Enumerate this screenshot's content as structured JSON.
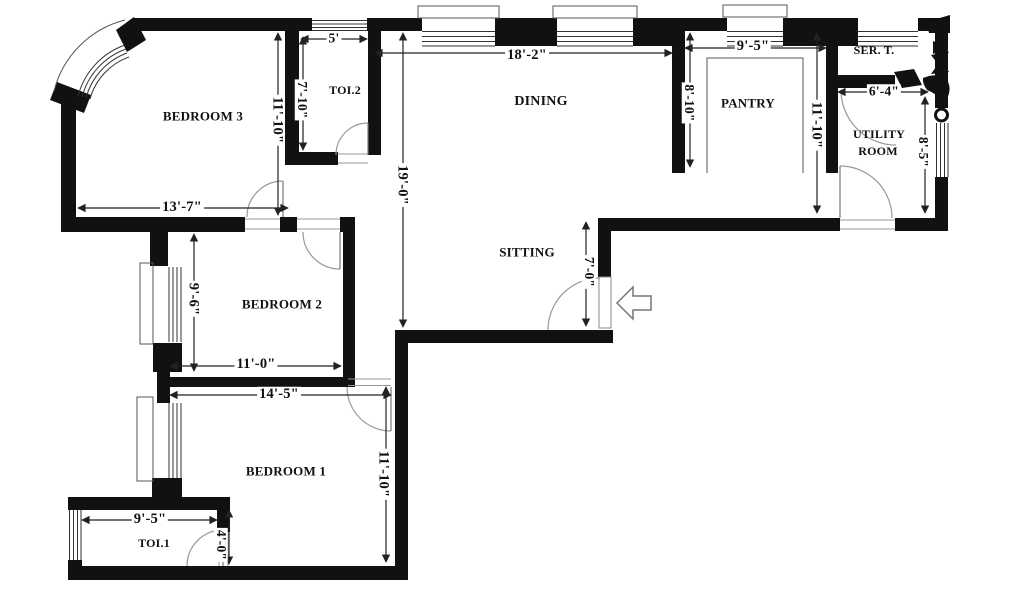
{
  "rooms": {
    "bedroom3": "BEDROOM 3",
    "toi2": "TOI.2",
    "dining": "DINING",
    "pantry": "PANTRY",
    "ser_t": "SER. T.",
    "utility_line1": "UTILITY",
    "utility_line2": "ROOM",
    "sitting": "SITTING",
    "bedroom2": "BEDROOM 2",
    "bedroom1": "BEDROOM 1",
    "toi1": "TOI.1"
  },
  "dimensions": {
    "bedroom3_width": "13'-7\"",
    "bedroom3_height": "11'-10\"",
    "toi2_width": "5'",
    "toi2_height": "7'-10\"",
    "dining_width": "18'-2\"",
    "dining_height": "19'-0\"",
    "pantry_width": "9'-5\"",
    "pantry_height": "8'-10\"",
    "pantry_side_height": "11'-10\"",
    "ser_t_width": "6'-4\"",
    "utility_height": "8'-5\"",
    "entry_height": "7'-0\"",
    "bedroom2_height": "9'-6\"",
    "bedroom2_width": "11'-0\"",
    "bedroom1_width": "14'-5\"",
    "bedroom1_height": "11'-10\"",
    "toi1_width": "9'-5\"",
    "toi1_height": "4'-0\""
  }
}
